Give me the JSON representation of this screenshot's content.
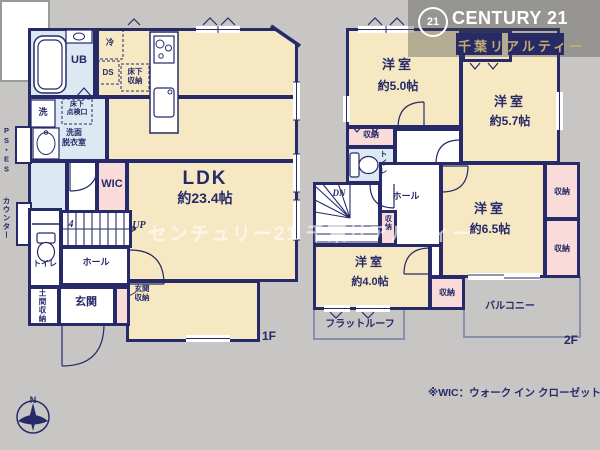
{
  "brand": {
    "badge": "21",
    "name": "CENTURY 21",
    "sub": "千葉リアルティー"
  },
  "watermark": "センチュリー21 千葉リアルティー",
  "footnote": "※WIC：ウォーク イン クローゼット",
  "compass": {
    "n": "N"
  },
  "colors": {
    "background": "#c7c6c4",
    "wall": "#262a69",
    "room_cream": "#f6e8c3",
    "wet_blue": "#dce8f2",
    "closet_pink": "#f9dcda",
    "brand_gold": "#c2af6e",
    "brand_navy": "#272a66"
  },
  "plan1": {
    "floor": "1F",
    "ldk_name": "LDK",
    "ldk_size": "約23.4帖",
    "ub": "UB",
    "rei": "冷",
    "ds": "DS",
    "yukashita": "床下\n収納",
    "tenkenko": "床下\n点検口",
    "sen": "洗",
    "senmen": "洗面\n脱衣室",
    "ps": "PS・ES",
    "counter": "カウンター",
    "wic": "WIC",
    "four": "4",
    "up": "UP",
    "toilet": "トイレ",
    "hall": "ホール",
    "genkan": "玄関",
    "doma": "土間収納",
    "gshuno": "玄関\n収納"
  },
  "plan2": {
    "floor": "2F",
    "rooms": [
      {
        "name": "洋室",
        "size": "約5.0帖"
      },
      {
        "name": "洋室",
        "size": "約5.7帖"
      },
      {
        "name": "洋室",
        "size": "約6.5帖"
      },
      {
        "name": "洋室",
        "size": "約4.0帖"
      }
    ],
    "closet": "収納",
    "toilet": "トイレ",
    "hall": "ホール",
    "dn": "DN",
    "balcony": "バルコニー",
    "flat_roof": "フラットルーフ"
  }
}
